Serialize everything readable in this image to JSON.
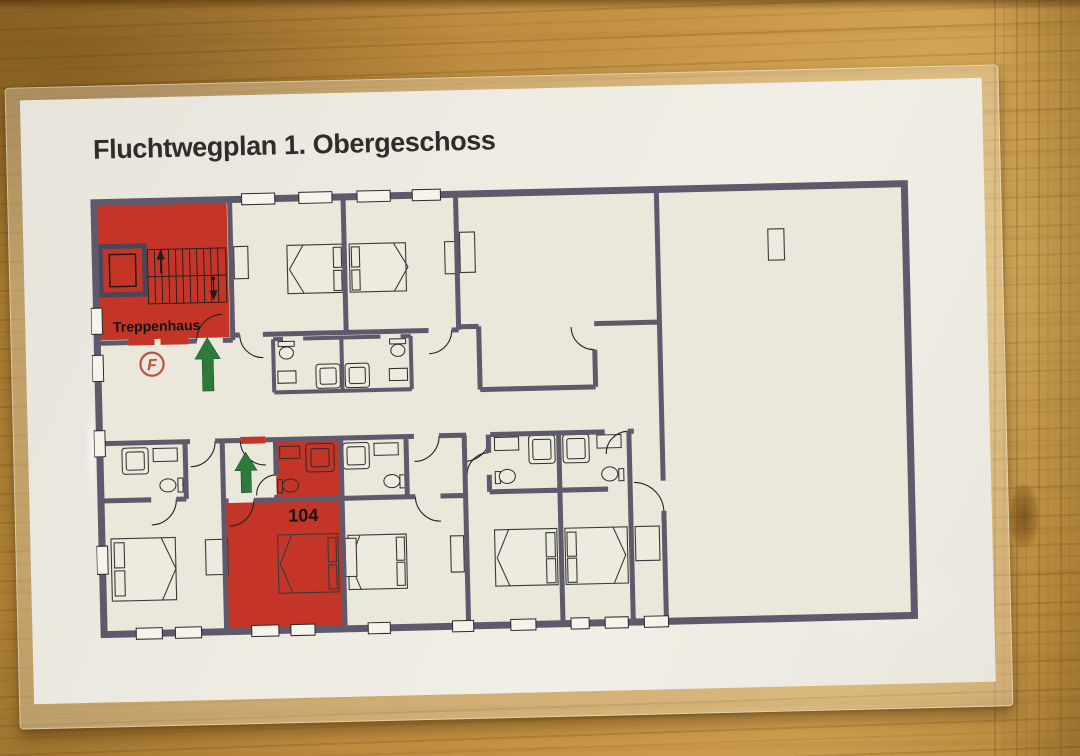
{
  "title": "Fluchtwegplan 1. Obergeschoss",
  "plan": {
    "stairwell_label": "Treppenhaus",
    "highlighted_room_number": "104",
    "fire_symbol_letter": "F",
    "icons": {
      "escape_direction": "green-up-arrow",
      "fire_equipment": "red-circled-F",
      "stairs": "stair-treads-with-up-down-arrows",
      "elevator": "elevator-shaft"
    },
    "colors": {
      "escape_highlight_red": "#c43527",
      "arrow_green": "#2e7a3c",
      "wall_gray_violet": "#5e5a6c",
      "paper_offwhite": "#eae8db",
      "wood_table": "#c59545"
    }
  }
}
